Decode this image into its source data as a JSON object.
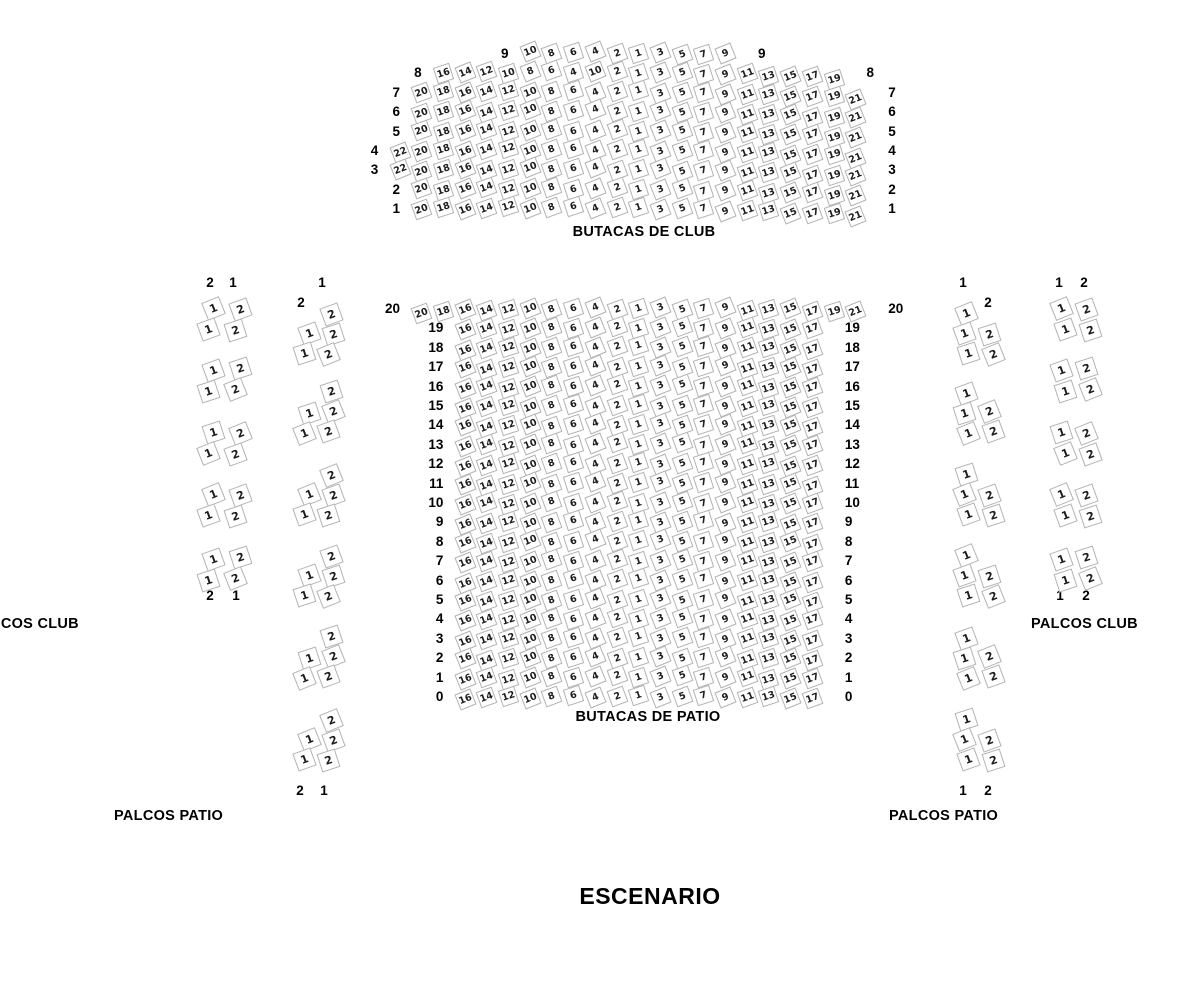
{
  "labels": {
    "club_title": "BUTACAS DE CLUB",
    "patio_title": "BUTACAS DE PATIO",
    "palcos_club_left": "PALCOS CLUB",
    "palcos_club_right": "PALCOS CLUB",
    "palcos_patio_left": "PALCOS PATIO",
    "palcos_patio_right": "PALCOS PATIO",
    "stage": "ESCENARIO"
  },
  "colors": {
    "seat_border": "#b3b3b3",
    "seat_fill": "#ffffff",
    "seat_text": "#1c1c1c",
    "label_text": "#000000"
  },
  "club_section": {
    "rows": [
      {
        "label": "9",
        "end_col": 15,
        "seats": [
          "10",
          "8",
          "6",
          "4",
          "2",
          "1",
          "3",
          "5",
          "7",
          "9"
        ]
      },
      {
        "label": "8",
        "end_col": 20,
        "seats": [
          "16",
          "14",
          "12",
          "10",
          "8",
          "6",
          "4",
          "10",
          "2",
          "1",
          "3",
          "5",
          "7",
          "9",
          "11",
          "13",
          "15",
          "17",
          "19"
        ]
      },
      {
        "label": "7",
        "end_col": 21,
        "seats": [
          "20",
          "18",
          "16",
          "14",
          "12",
          "10",
          "8",
          "6",
          "4",
          "2",
          "1",
          "3",
          "5",
          "7",
          "9",
          "11",
          "13",
          "15",
          "17",
          "19",
          "21"
        ]
      },
      {
        "label": "6",
        "end_col": 21,
        "seats": [
          "20",
          "18",
          "16",
          "14",
          "12",
          "10",
          "8",
          "6",
          "4",
          "2",
          "1",
          "3",
          "5",
          "7",
          "9",
          "11",
          "13",
          "15",
          "17",
          "19",
          "21"
        ]
      },
      {
        "label": "5",
        "end_col": 21,
        "seats": [
          "20",
          "18",
          "16",
          "14",
          "12",
          "10",
          "8",
          "6",
          "4",
          "2",
          "1",
          "3",
          "5",
          "7",
          "9",
          "11",
          "13",
          "15",
          "17",
          "19",
          "21"
        ]
      },
      {
        "label": "4",
        "end_col": 21,
        "seats": [
          "22",
          "20",
          "18",
          "16",
          "14",
          "12",
          "10",
          "8",
          "6",
          "4",
          "2",
          "1",
          "3",
          "5",
          "7",
          "9",
          "11",
          "13",
          "15",
          "17",
          "19",
          "21"
        ]
      },
      {
        "label": "3",
        "end_col": 21,
        "seats": [
          "22",
          "20",
          "18",
          "16",
          "14",
          "12",
          "10",
          "8",
          "6",
          "4",
          "2",
          "1",
          "3",
          "5",
          "7",
          "9",
          "11",
          "13",
          "15",
          "17",
          "19",
          "21"
        ]
      },
      {
        "label": "2",
        "end_col": 21,
        "seats": [
          "20",
          "18",
          "16",
          "14",
          "12",
          "10",
          "8",
          "6",
          "4",
          "2",
          "1",
          "3",
          "5",
          "7",
          "9",
          "11",
          "13",
          "15",
          "17",
          "19",
          "21"
        ]
      },
      {
        "label": "1",
        "end_col": 21,
        "seats": [
          "20",
          "18",
          "16",
          "14",
          "12",
          "10",
          "8",
          "6",
          "4",
          "2",
          "1",
          "3",
          "5",
          "7",
          "9",
          "11",
          "13",
          "15",
          "17",
          "19",
          "21"
        ]
      }
    ]
  },
  "patio_section": {
    "rows": [
      {
        "label": "20",
        "end_col": 21,
        "seats": [
          "20",
          "18",
          "16",
          "14",
          "12",
          "10",
          "8",
          "6",
          "4",
          "2",
          "1",
          "3",
          "5",
          "7",
          "9",
          "11",
          "13",
          "15",
          "17",
          "19",
          "21"
        ]
      },
      {
        "label": "19",
        "end_col": 19,
        "seats": [
          "16",
          "14",
          "12",
          "10",
          "8",
          "6",
          "4",
          "2",
          "1",
          "3",
          "5",
          "7",
          "9",
          "11",
          "13",
          "15",
          "17"
        ]
      },
      {
        "label": "18",
        "end_col": 19,
        "seats": [
          "16",
          "14",
          "12",
          "10",
          "8",
          "6",
          "4",
          "2",
          "1",
          "3",
          "5",
          "7",
          "9",
          "11",
          "13",
          "15",
          "17"
        ]
      },
      {
        "label": "17",
        "end_col": 19,
        "seats": [
          "16",
          "14",
          "12",
          "10",
          "8",
          "6",
          "4",
          "2",
          "1",
          "3",
          "5",
          "7",
          "9",
          "11",
          "13",
          "15",
          "17"
        ]
      },
      {
        "label": "16",
        "end_col": 19,
        "seats": [
          "16",
          "14",
          "12",
          "10",
          "8",
          "6",
          "4",
          "2",
          "1",
          "3",
          "5",
          "7",
          "9",
          "11",
          "13",
          "15",
          "17"
        ]
      },
      {
        "label": "15",
        "end_col": 19,
        "seats": [
          "16",
          "14",
          "12",
          "10",
          "8",
          "6",
          "4",
          "2",
          "1",
          "3",
          "5",
          "7",
          "9",
          "11",
          "13",
          "15",
          "17"
        ]
      },
      {
        "label": "14",
        "end_col": 19,
        "seats": [
          "16",
          "14",
          "12",
          "10",
          "8",
          "6",
          "4",
          "2",
          "1",
          "3",
          "5",
          "7",
          "9",
          "11",
          "13",
          "15",
          "17"
        ]
      },
      {
        "label": "13",
        "end_col": 19,
        "seats": [
          "16",
          "14",
          "12",
          "10",
          "8",
          "6",
          "4",
          "2",
          "1",
          "3",
          "5",
          "7",
          "9",
          "11",
          "13",
          "15",
          "17"
        ]
      },
      {
        "label": "12",
        "end_col": 19,
        "seats": [
          "16",
          "14",
          "12",
          "10",
          "8",
          "6",
          "4",
          "2",
          "1",
          "3",
          "5",
          "7",
          "9",
          "11",
          "13",
          "15",
          "17"
        ]
      },
      {
        "label": "11",
        "end_col": 19,
        "seats": [
          "16",
          "14",
          "12",
          "10",
          "8",
          "6",
          "4",
          "2",
          "1",
          "3",
          "5",
          "7",
          "9",
          "11",
          "13",
          "15",
          "17"
        ]
      },
      {
        "label": "10",
        "end_col": 19,
        "seats": [
          "16",
          "14",
          "12",
          "10",
          "8",
          "6",
          "4",
          "2",
          "1",
          "3",
          "5",
          "7",
          "9",
          "11",
          "13",
          "15",
          "17"
        ]
      },
      {
        "label": "9",
        "end_col": 19,
        "seats": [
          "16",
          "14",
          "12",
          "10",
          "8",
          "6",
          "4",
          "2",
          "1",
          "3",
          "5",
          "7",
          "9",
          "11",
          "13",
          "15",
          "17"
        ]
      },
      {
        "label": "8",
        "end_col": 19,
        "seats": [
          "16",
          "14",
          "12",
          "10",
          "8",
          "6",
          "4",
          "2",
          "1",
          "3",
          "5",
          "7",
          "9",
          "11",
          "13",
          "15",
          "17"
        ]
      },
      {
        "label": "7",
        "end_col": 19,
        "seats": [
          "16",
          "14",
          "12",
          "10",
          "8",
          "6",
          "4",
          "2",
          "1",
          "3",
          "5",
          "7",
          "9",
          "11",
          "13",
          "15",
          "17"
        ]
      },
      {
        "label": "6",
        "end_col": 19,
        "seats": [
          "16",
          "14",
          "12",
          "10",
          "8",
          "6",
          "4",
          "2",
          "1",
          "3",
          "5",
          "7",
          "9",
          "11",
          "13",
          "15",
          "17"
        ]
      },
      {
        "label": "5",
        "end_col": 19,
        "seats": [
          "16",
          "14",
          "12",
          "10",
          "8",
          "6",
          "4",
          "2",
          "1",
          "3",
          "5",
          "7",
          "9",
          "11",
          "13",
          "15",
          "17"
        ]
      },
      {
        "label": "4",
        "end_col": 19,
        "seats": [
          "16",
          "14",
          "12",
          "10",
          "8",
          "6",
          "4",
          "2",
          "1",
          "3",
          "5",
          "7",
          "9",
          "11",
          "13",
          "15",
          "17"
        ]
      },
      {
        "label": "3",
        "end_col": 19,
        "seats": [
          "16",
          "14",
          "12",
          "10",
          "8",
          "6",
          "4",
          "2",
          "1",
          "3",
          "5",
          "7",
          "9",
          "11",
          "13",
          "15",
          "17"
        ]
      },
      {
        "label": "2",
        "end_col": 19,
        "seats": [
          "16",
          "14",
          "12",
          "10",
          "8",
          "6",
          "4",
          "2",
          "1",
          "3",
          "5",
          "7",
          "9",
          "11",
          "13",
          "15",
          "17"
        ]
      },
      {
        "label": "1",
        "end_col": 19,
        "seats": [
          "16",
          "14",
          "12",
          "10",
          "8",
          "6",
          "4",
          "2",
          "1",
          "3",
          "5",
          "7",
          "9",
          "11",
          "13",
          "15",
          "17"
        ]
      },
      {
        "label": "0",
        "end_col": 19,
        "seats": [
          "16",
          "14",
          "12",
          "10",
          "8",
          "6",
          "4",
          "2",
          "1",
          "3",
          "5",
          "7",
          "9",
          "11",
          "13",
          "15",
          "17"
        ]
      }
    ]
  },
  "palcos": {
    "left_club": {
      "header": [
        "2",
        "1"
      ],
      "footer": [
        "2",
        "1"
      ],
      "groups": [
        [
          [
            "1",
            "2"
          ],
          [
            "1",
            "2"
          ]
        ],
        [
          [
            "1",
            "2"
          ],
          [
            "1",
            "2"
          ]
        ],
        [
          [
            "1",
            "2"
          ],
          [
            "1",
            "2"
          ]
        ],
        [
          [
            "1",
            "2"
          ],
          [
            "1",
            "2"
          ]
        ],
        [
          [
            "1",
            "2"
          ],
          [
            "1",
            "2"
          ]
        ]
      ]
    },
    "left_patio": {
      "header": [
        "1",
        "2"
      ],
      "footer": [
        "2",
        "1"
      ],
      "groups": [
        [
          [
            null,
            "2"
          ],
          [
            "1",
            "2"
          ],
          [
            "1",
            "2"
          ]
        ],
        [
          [
            null,
            "2"
          ],
          [
            "1",
            "2"
          ],
          [
            "1",
            "2"
          ]
        ],
        [
          [
            null,
            "2"
          ],
          [
            "1",
            "2"
          ],
          [
            "1",
            "2"
          ]
        ],
        [
          [
            null,
            "2"
          ],
          [
            "1",
            "2"
          ],
          [
            "1",
            "2"
          ]
        ],
        [
          [
            null,
            "2"
          ],
          [
            "1",
            "2"
          ],
          [
            "1",
            "2"
          ]
        ],
        [
          [
            null,
            "2"
          ],
          [
            "1",
            "2"
          ],
          [
            "1",
            "2"
          ]
        ]
      ]
    },
    "right_patio": {
      "header": [
        "1",
        "2"
      ],
      "footer": [
        "1",
        "2"
      ],
      "groups": [
        [
          [
            "1",
            null
          ],
          [
            "1",
            "2"
          ],
          [
            "1",
            "2"
          ]
        ],
        [
          [
            "1",
            null
          ],
          [
            "1",
            "2"
          ],
          [
            "1",
            "2"
          ]
        ],
        [
          [
            "1",
            null
          ],
          [
            "1",
            "2"
          ],
          [
            "1",
            "2"
          ]
        ],
        [
          [
            "1",
            null
          ],
          [
            "1",
            "2"
          ],
          [
            "1",
            "2"
          ]
        ],
        [
          [
            "1",
            null
          ],
          [
            "1",
            "2"
          ],
          [
            "1",
            "2"
          ]
        ],
        [
          [
            "1",
            null
          ],
          [
            "1",
            "2"
          ],
          [
            "1",
            "2"
          ]
        ]
      ]
    },
    "right_club": {
      "header": [
        "1",
        "2"
      ],
      "footer": [
        "1",
        "2"
      ],
      "groups": [
        [
          [
            "1",
            "2"
          ],
          [
            "1",
            "2"
          ]
        ],
        [
          [
            "1",
            "2"
          ],
          [
            "1",
            "2"
          ]
        ],
        [
          [
            "1",
            "2"
          ],
          [
            "1",
            "2"
          ]
        ],
        [
          [
            "1",
            "2"
          ],
          [
            "1",
            "2"
          ]
        ],
        [
          [
            "1",
            "2"
          ],
          [
            "1",
            "2"
          ]
        ]
      ]
    }
  }
}
